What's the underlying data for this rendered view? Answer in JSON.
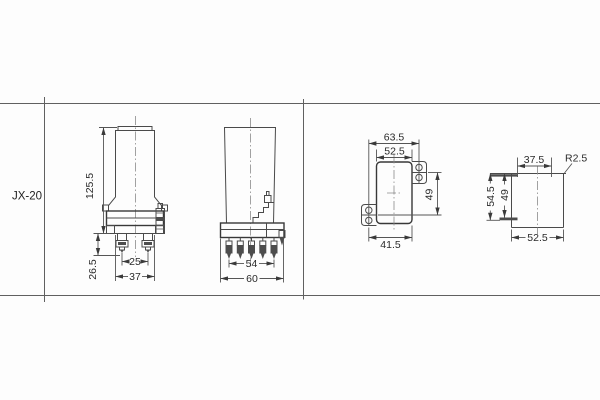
{
  "table": {
    "row_label": "JX-20"
  },
  "front_view": {
    "dim_height": "125.5",
    "dim_terminal_length": "26.5",
    "dim_terminal_spacing": "25",
    "dim_width": "37"
  },
  "side_view": {
    "dim_pin_span": "54",
    "dim_width": "60"
  },
  "cutout_view": {
    "dim_hole_span_h": "63.5",
    "dim_width": "52.5",
    "dim_hole_span_v": "49",
    "dim_lower_width": "41.5"
  },
  "drill_view": {
    "dim_hole_span_h": "37.5",
    "dim_corner_radius": "R2.5",
    "dim_overall_height": "54.5",
    "dim_hole_span_v": "49",
    "dim_width": "52.5"
  }
}
